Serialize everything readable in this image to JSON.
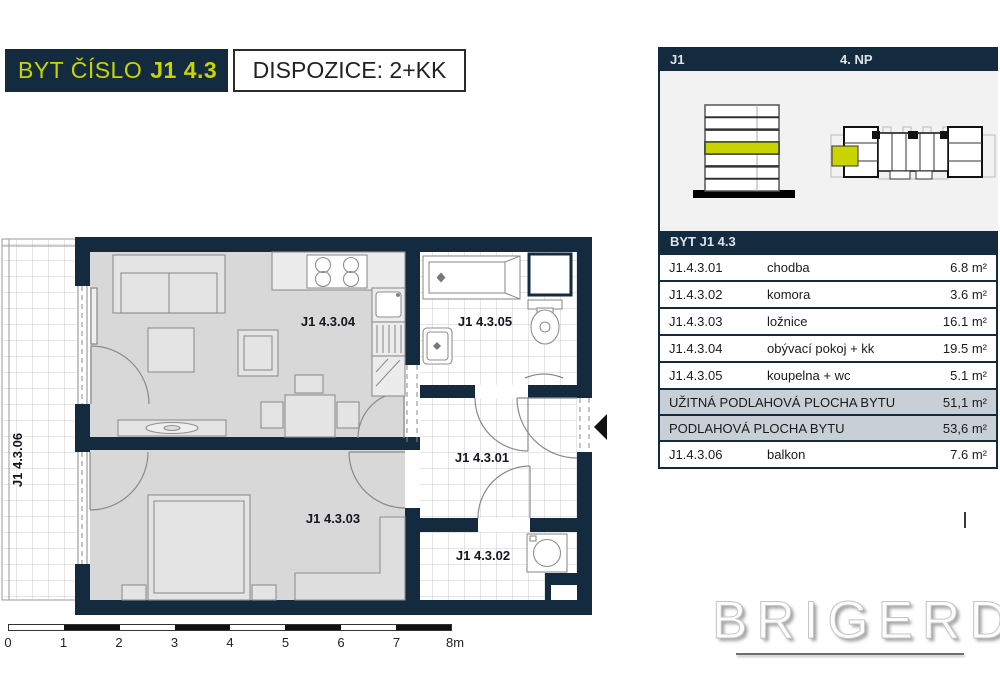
{
  "title": {
    "byt_label": "BYT ČÍSLO",
    "byt_number": "J1 4.3",
    "dispozice": "DISPOZICE: 2+KK"
  },
  "panel": {
    "block_label": "J1",
    "floor_label": "4. NP",
    "table": {
      "header": "BYT J1 4.3",
      "rooms": [
        {
          "code": "J1.4.3.01",
          "name": "chodba",
          "area": "6.8 m²"
        },
        {
          "code": "J1.4.3.02",
          "name": "komora",
          "area": "3.6 m²"
        },
        {
          "code": "J1.4.3.03",
          "name": "ložnice",
          "area": "16.1 m²"
        },
        {
          "code": "J1.4.3.04",
          "name": "obývací pokoj + kk",
          "area": "19.5 m²"
        },
        {
          "code": "J1.4.3.05",
          "name": "koupelna + wc",
          "area": "5.1 m²"
        }
      ],
      "totals": [
        {
          "label": "UŽITNÁ PODLAHOVÁ PLOCHA BYTU",
          "area": "51,1 m²"
        },
        {
          "label": "PODLAHOVÁ PLOCHA BYTU",
          "area": "53,6 m²"
        }
      ],
      "balcony": {
        "code": "J1.4.3.06",
        "name": "balkon",
        "area": "7.6 m²"
      }
    }
  },
  "plan": {
    "labels": {
      "r01": "J1 4.3.01",
      "r02": "J1 4.3.02",
      "r03": "J1 4.3.03",
      "r04": "J1 4.3.04",
      "r05": "J1 4.3.05",
      "r06": "J1 4.3.06"
    }
  },
  "scalebar": {
    "labels": [
      "0",
      "1",
      "2",
      "3",
      "4",
      "5",
      "6",
      "7",
      "8m"
    ]
  },
  "logo": {
    "text": "BRIGERD"
  },
  "colors": {
    "navy": "#132a3f",
    "lime": "#c9d400",
    "summary_bg": "#c8cfd6",
    "floor_grey": "#d8d8d8",
    "panel_bg": "#f2f2f2"
  }
}
